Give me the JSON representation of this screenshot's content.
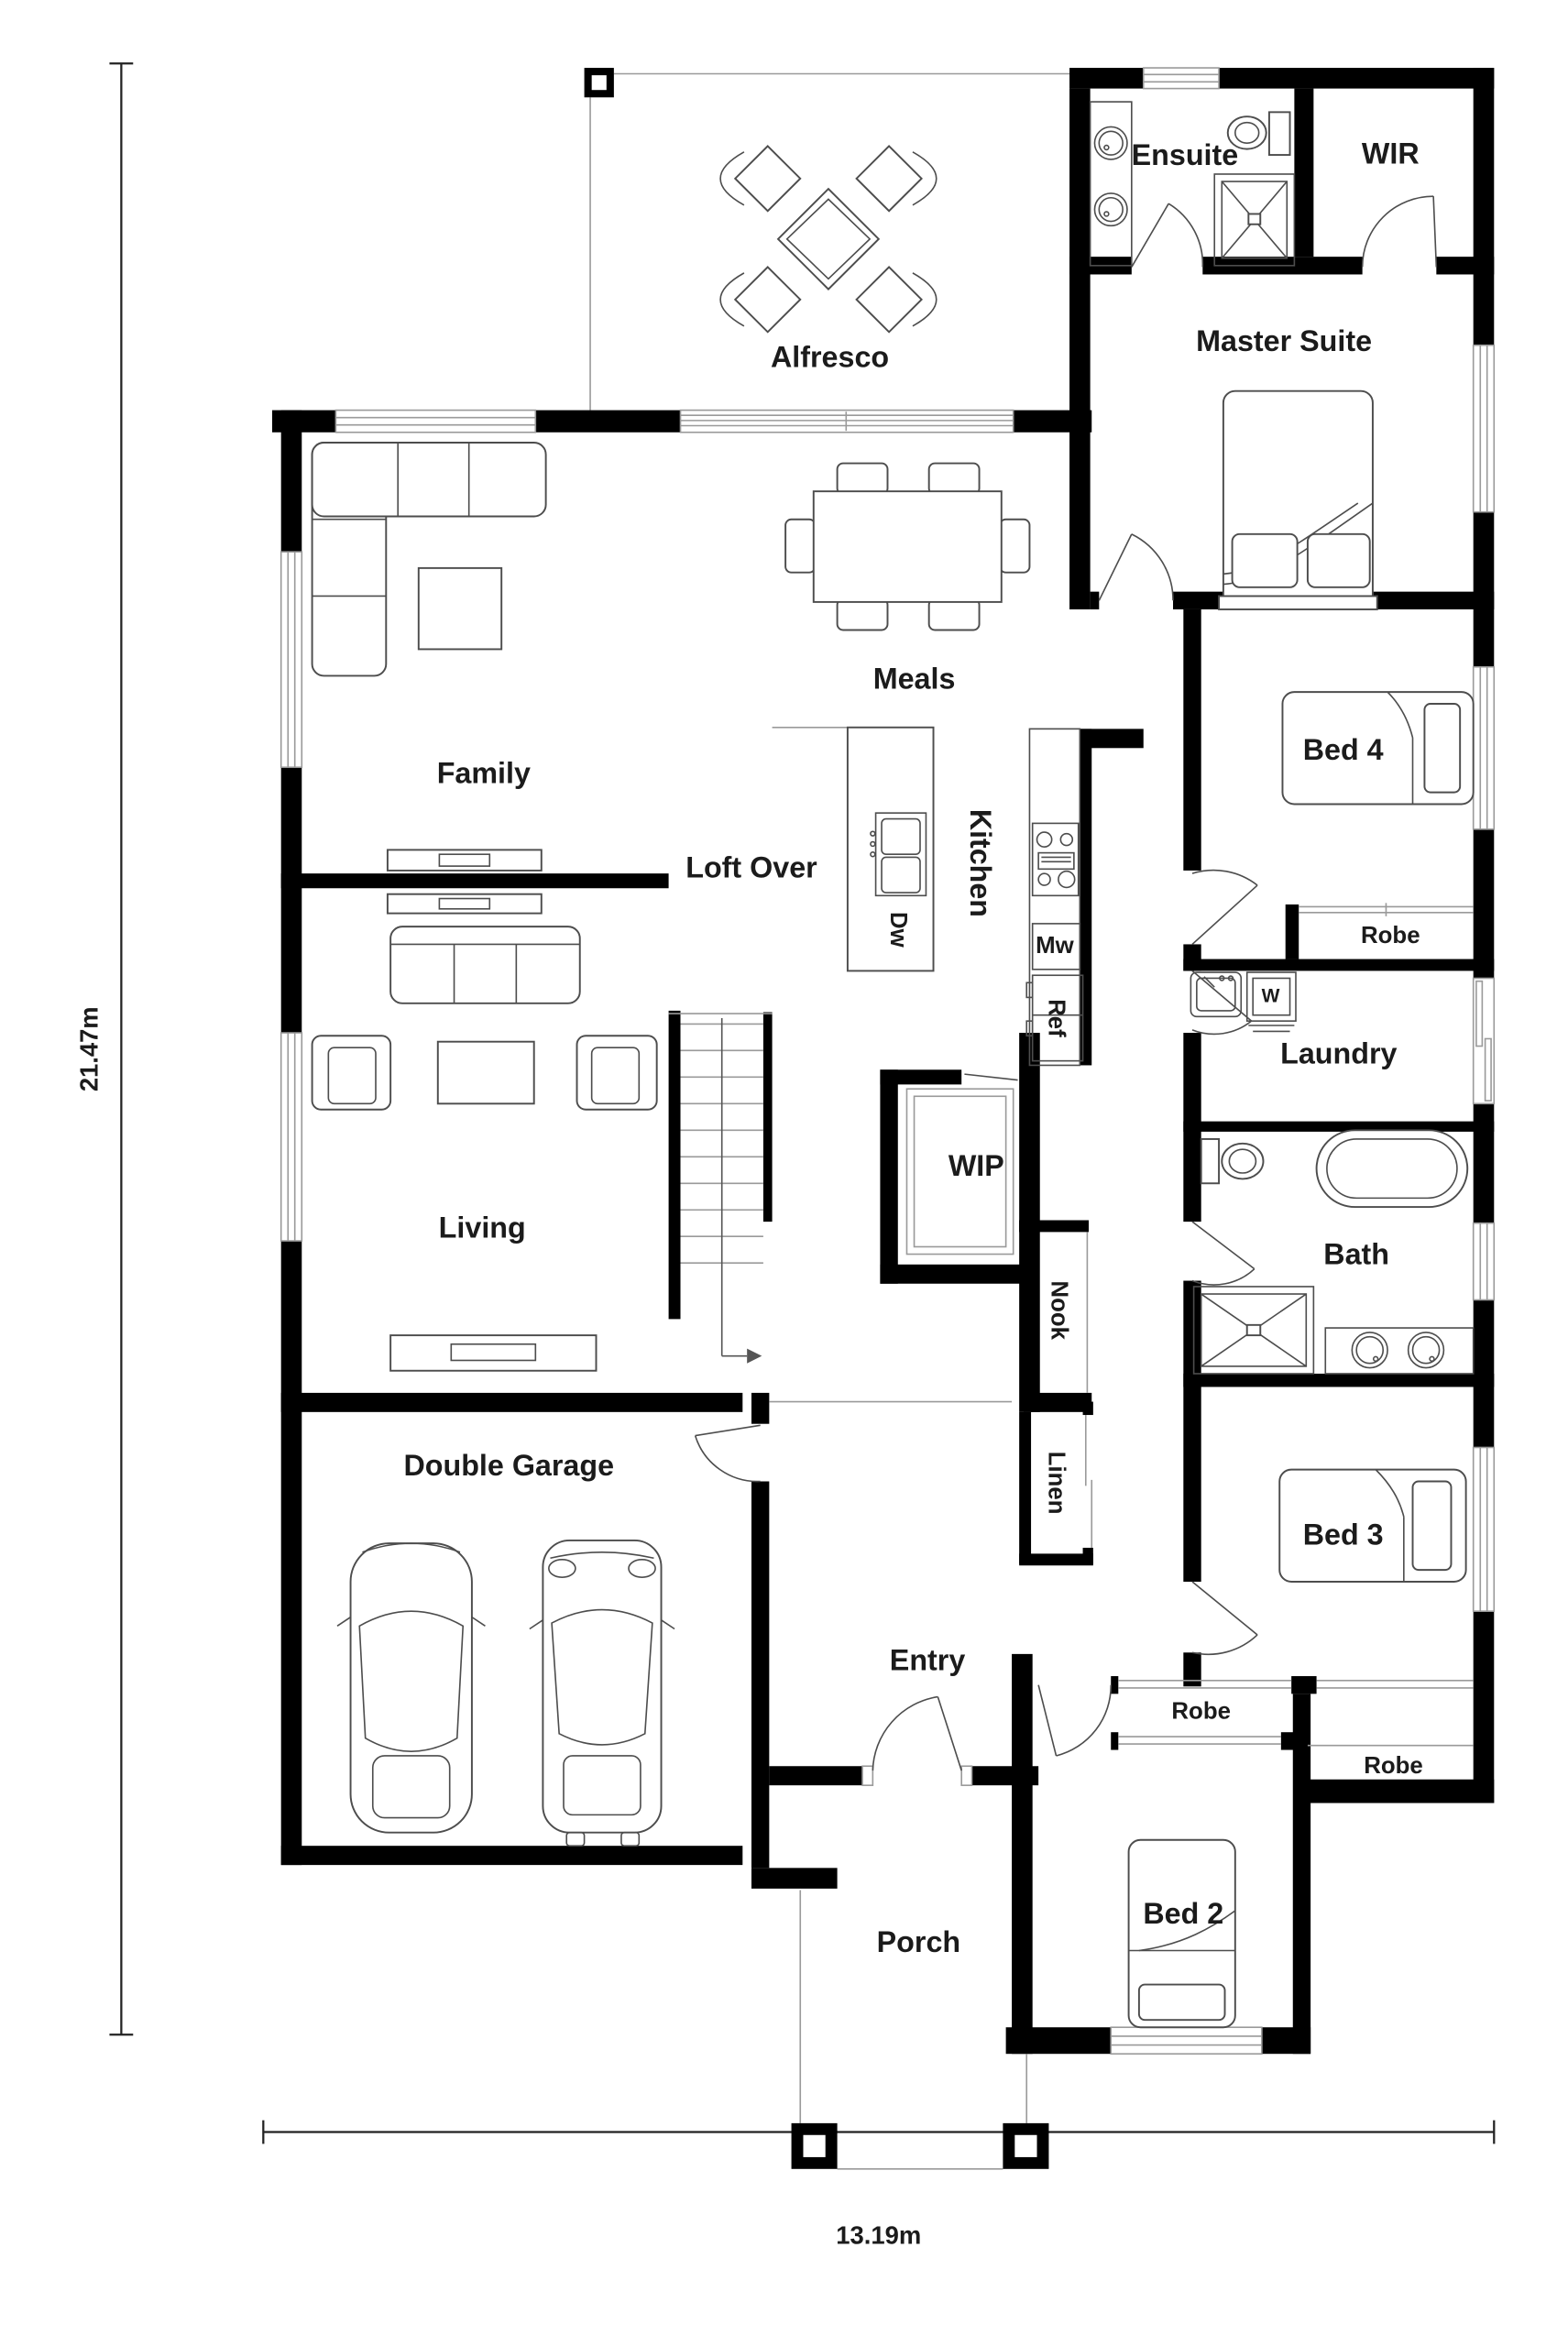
{
  "colors": {
    "wall": "#000000",
    "text": "#1b1b1b",
    "furniture": "#4d4d4d",
    "thin": "#9a9a9a",
    "background": "#ffffff"
  },
  "dimensions": {
    "height": "21.47m",
    "width": "13.19m"
  },
  "labels": {
    "alfresco": "Alfresco",
    "ensuite": "Ensuite",
    "wir": "WIR",
    "master_suite": "Master Suite",
    "meals": "Meals",
    "family": "Family",
    "loft_over": "Loft Over",
    "kitchen": "Kitchen",
    "dishwasher": "Dw",
    "microwave": "Mw",
    "refrigerator": "Ref",
    "bed4": "Bed 4",
    "robe_bed4": "Robe",
    "laundry": "Laundry",
    "washer": "W",
    "wip": "WIP",
    "nook": "Nook",
    "bath": "Bath",
    "living": "Living",
    "linen": "Linen",
    "bed3": "Bed 3",
    "double_garage": "Double Garage",
    "entry": "Entry",
    "robe_bed2": "Robe",
    "robe_bed3": "Robe",
    "bed2": "Bed 2",
    "porch": "Porch"
  }
}
